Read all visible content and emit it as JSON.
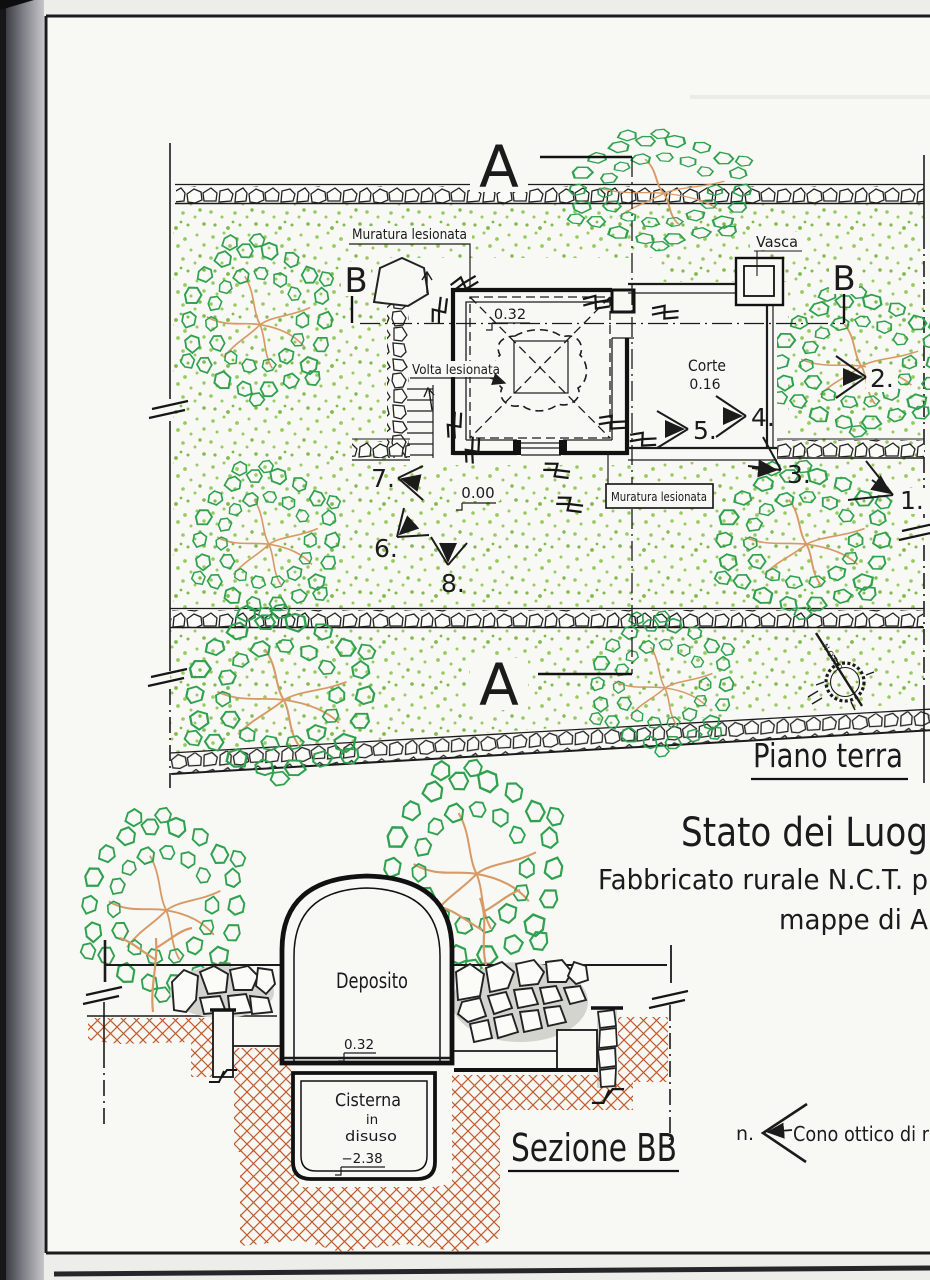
{
  "plan": {
    "marker_a_top": "A",
    "marker_a_bottom": "A",
    "marker_b_left": "B",
    "marker_b_right": "B",
    "label_muratura_top": "Muratura lesionata",
    "label_muratura_box": "Muratura lesionata",
    "label_volta": "Volta lesionata",
    "label_vasca": "Vasca",
    "label_corte": "Corte",
    "corte_level": "0.16",
    "level_building": "0.32",
    "level_ground": "0.00",
    "compass_north": "NORD",
    "cones": {
      "c1": "1.",
      "c2": "2.",
      "c3": "3.",
      "c4": "4.",
      "c5": "5.",
      "c6": "6.",
      "c7": "7.",
      "c8": "8."
    },
    "caption": "Piano terra"
  },
  "titles": {
    "line1": "Stato dei Luog",
    "line2": "Fabbricato rurale N.C.T. p",
    "line3": "mappe di A"
  },
  "section": {
    "room": "Deposito",
    "level_floor": "0.32",
    "cistern_line1": "Cisterna",
    "cistern_line2": "in",
    "cistern_line3": "disuso",
    "level_cistern": "−2.38",
    "caption": "Sezione BB"
  },
  "legend": {
    "index": "n.",
    "label": "Cono ottico di r"
  },
  "colors": {
    "paper": "#f8f8f5",
    "ink": "#1b1b1b",
    "foliage": "#2fa14f",
    "stipple": "#94c95c",
    "branch": "#d79a66",
    "earth": "#c05a2c"
  }
}
